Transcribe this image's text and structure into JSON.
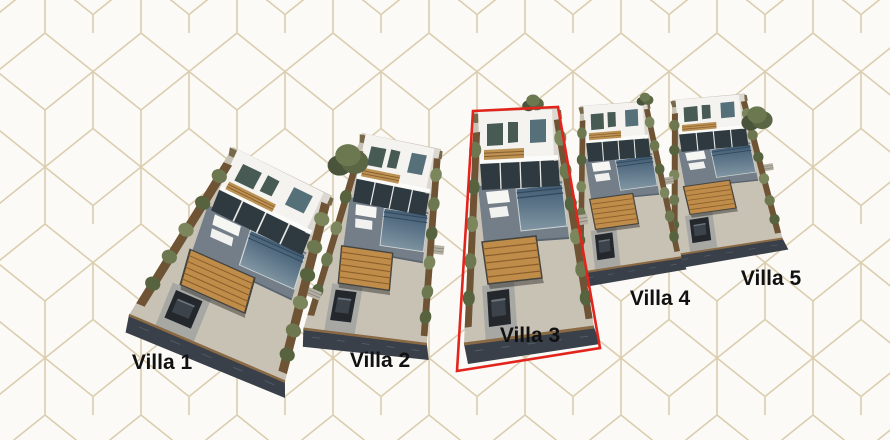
{
  "scene": {
    "description": "Aerial 3D architectural rendering of a five-villa development on a white geometric cube-pattern background; Villa 3 plot is outlined in red",
    "background": {
      "base_color": "#fbfaf7",
      "pattern_line_color": "#dbcdae"
    },
    "highlight": {
      "villa": "Villa 3",
      "color": "#e1251c",
      "polygon": "473,111 558,107 600,348 457,371"
    },
    "villas": [
      {
        "label": "Villa 1",
        "highlighted": false,
        "label_x": 162,
        "label_y": 369,
        "tx": 233,
        "ty": 147,
        "rot": 28,
        "sx": 1.3,
        "sy": 0.85
      },
      {
        "label": "Villa 2",
        "highlighted": false,
        "label_x": 380,
        "label_y": 367,
        "tx": 362,
        "ty": 133,
        "rot": 14,
        "sx": 0.95,
        "sy": 0.88
      },
      {
        "label": "Villa 3",
        "highlighted": true,
        "label_x": 530,
        "label_y": 342,
        "tx": 474,
        "ty": 112,
        "rot": 0,
        "sx": 1.0,
        "sy": 1.0
      },
      {
        "label": "Villa 4",
        "highlighted": false,
        "label_x": 660,
        "label_y": 305,
        "tx": 580,
        "ty": 106,
        "rot": -2,
        "sx": 0.8,
        "sy": 0.72
      },
      {
        "label": "Villa 5",
        "highlighted": false,
        "label_x": 771,
        "label_y": 285,
        "tx": 672,
        "ty": 100,
        "rot": -3,
        "sx": 0.86,
        "sy": 0.67
      }
    ],
    "trees": [
      {
        "x": 348,
        "y": 162,
        "r": 17
      },
      {
        "x": 533,
        "y": 104,
        "r": 9
      },
      {
        "x": 645,
        "y": 100,
        "r": 7
      },
      {
        "x": 757,
        "y": 120,
        "r": 13
      }
    ],
    "palette": {
      "house_white": "#f4f3ef",
      "house_shadow": "#dcd8d1",
      "glass_dark": "#2e3940",
      "window_green": "#475a54",
      "window_blue": "#56707a",
      "wood_band": "#bb9154",
      "balcony": "#fbfbf9",
      "terrace": "#737e88",
      "terrace_edge": "#5a646e",
      "pool_top": "#3f5a72",
      "pool_bottom": "#8297a4",
      "pool_step": "#32485c",
      "pool_coping": "#cfd4d3",
      "pebble": "#c8c2b5",
      "rear_strip": "#77684a",
      "pergola_wood": "#bf8c49",
      "pergola_line": "#8a5e2b",
      "pergola_frame": "#44433d",
      "fence_wood": "#6f5335",
      "stone_wall": "#394049",
      "wall_cap": "#8a6a44",
      "wall_texture": "#535d68",
      "bush_green": "#6d7850",
      "bush_dark": "#57623f",
      "bush_light": "#7b865c",
      "lounger_white": "#f6f6f3",
      "car_body": "#24282d",
      "car_roof": "#3c434a",
      "car_glass": "#6a737c",
      "driveway": "#a7a8a4",
      "steps": "#b5b0a4",
      "steps_line": "#8d887c",
      "label_color": "#111111"
    }
  }
}
